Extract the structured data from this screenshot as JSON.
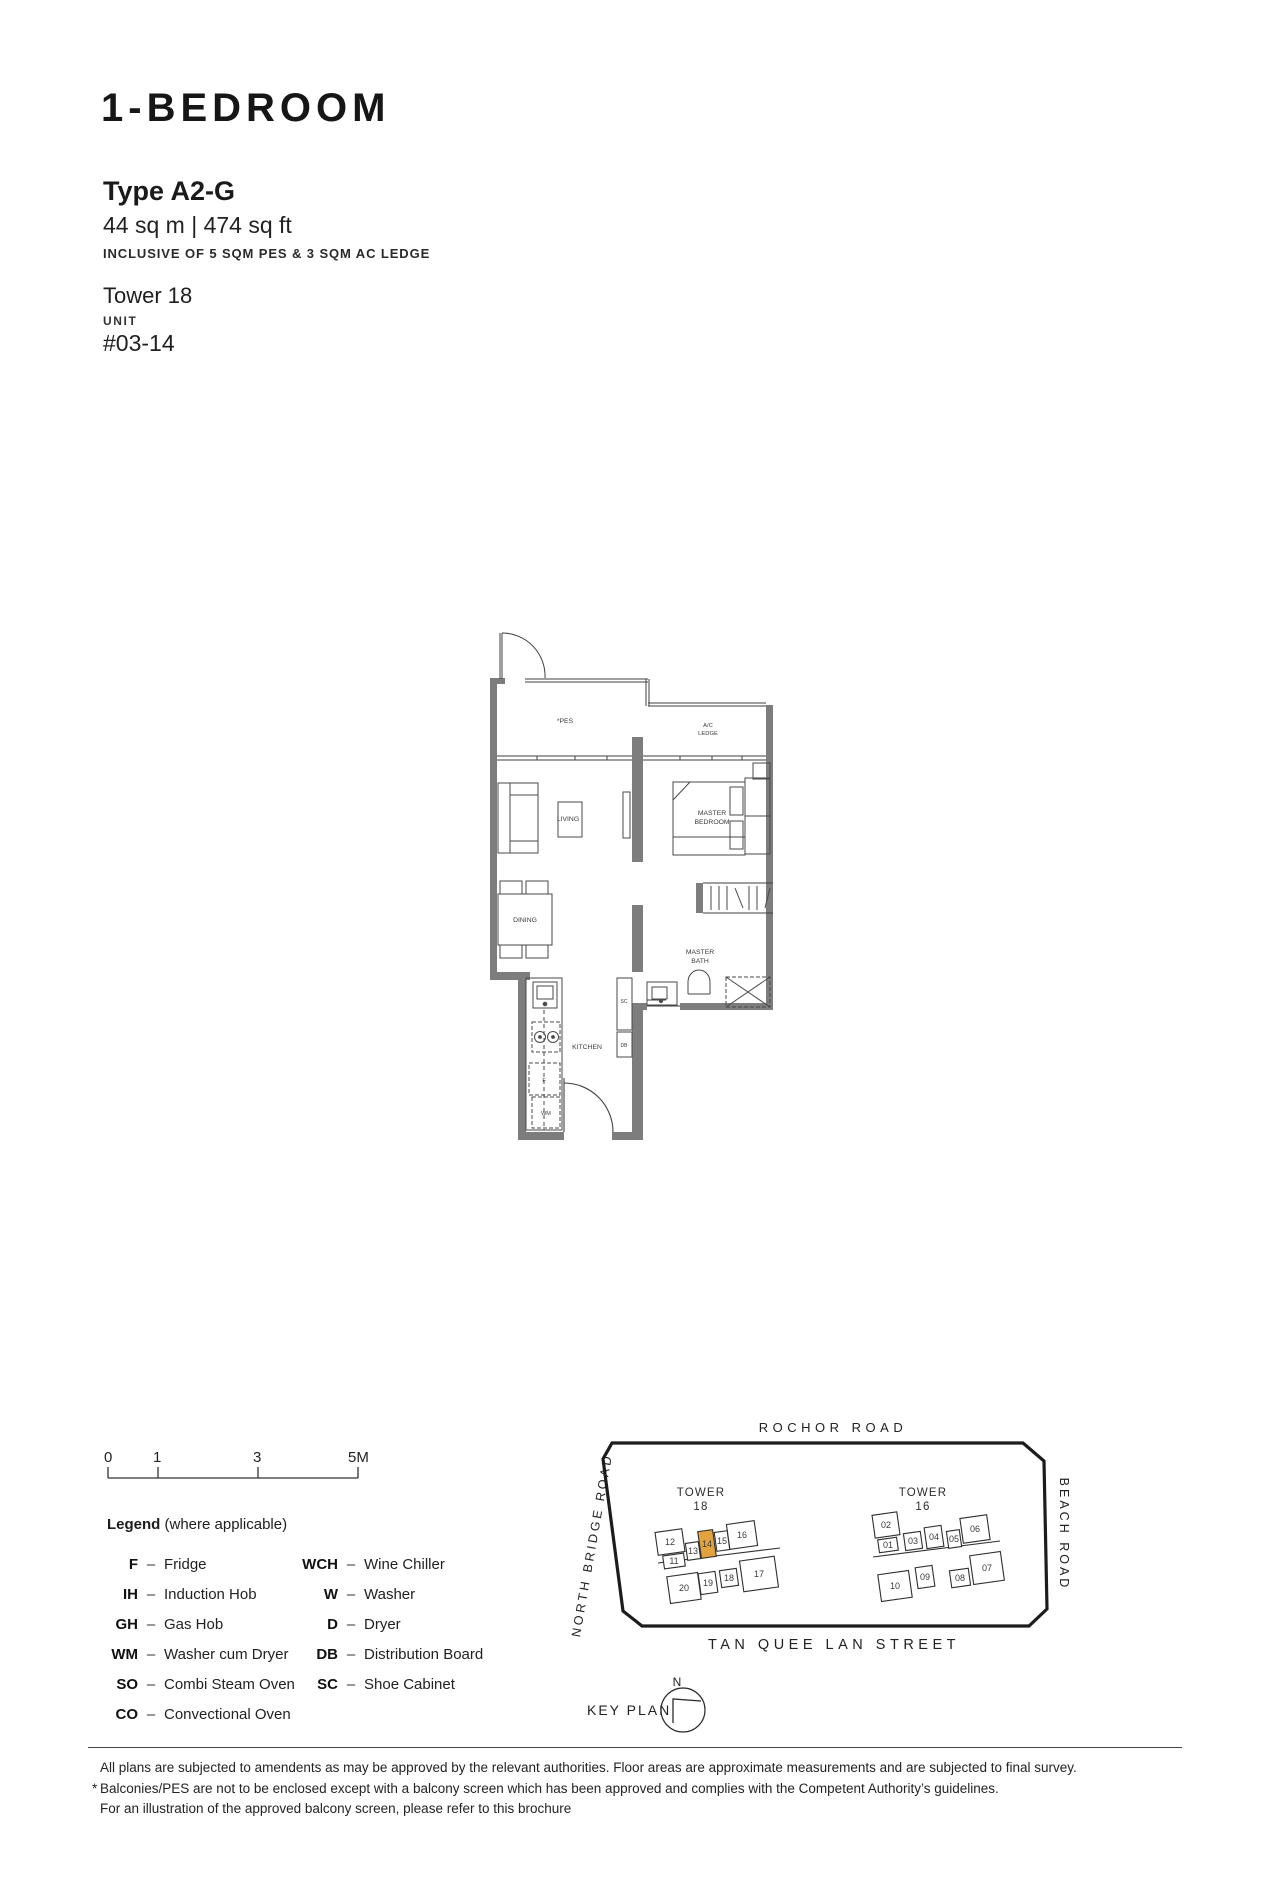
{
  "header": {
    "title": "1-BEDROOM",
    "type": "Type A2-G",
    "area": "44 sq m | 474 sq ft",
    "inclusive": "INCLUSIVE OF 5 SQM PES & 3 SQM AC LEDGE",
    "tower": "Tower 18",
    "unit_label": "UNIT",
    "unit_number": "#03-14"
  },
  "floor_plan": {
    "labels": {
      "pes": "*PES",
      "ac_ledge_1": "A/C",
      "ac_ledge_2": "LEDGE",
      "living": "LIVING",
      "master_bedroom_1": "MASTER",
      "master_bedroom_2": "BEDROOM",
      "dining": "DINING",
      "master_bath_1": "MASTER",
      "master_bath_2": "BATH",
      "kitchen": "KITCHEN",
      "shoe_cabinet": "SC",
      "distribution_board": "DB",
      "fridge": "F",
      "washer_dryer": "WM"
    }
  },
  "scale_bar": {
    "ticks": [
      "0",
      "1",
      "3",
      "5M"
    ]
  },
  "legend": {
    "title": "Legend",
    "subtitle": "(where applicable)",
    "separator": "–",
    "col1": [
      {
        "abbr": "F",
        "desc": "Fridge"
      },
      {
        "abbr": "IH",
        "desc": "Induction Hob"
      },
      {
        "abbr": "GH",
        "desc": "Gas Hob"
      },
      {
        "abbr": "WM",
        "desc": "Washer cum Dryer"
      },
      {
        "abbr": "SO",
        "desc": "Combi Steam Oven"
      },
      {
        "abbr": "CO",
        "desc": "Convectional Oven"
      }
    ],
    "col2": [
      {
        "abbr": "WCH",
        "desc": "Wine Chiller"
      },
      {
        "abbr": "W",
        "desc": "Washer"
      },
      {
        "abbr": "D",
        "desc": "Dryer"
      },
      {
        "abbr": "DB",
        "desc": "Distribution Board"
      },
      {
        "abbr": "SC",
        "desc": "Shoe Cabinet"
      }
    ]
  },
  "key_plan": {
    "roads": {
      "top": "ROCHOR ROAD",
      "left": "NORTH BRIDGE ROAD",
      "right": "BEACH ROAD",
      "bottom": "TAN QUEE LAN STREET"
    },
    "tower18": {
      "line1": "TOWER",
      "line2": "18",
      "units": [
        "12",
        "11",
        "13",
        "14",
        "15",
        "16",
        "20",
        "19",
        "18",
        "17"
      ]
    },
    "tower16": {
      "line1": "TOWER",
      "line2": "16",
      "units": [
        "02",
        "01",
        "03",
        "04",
        "05",
        "06",
        "10",
        "09",
        "08",
        "07"
      ]
    },
    "highlighted_unit": "14",
    "highlight_color": "#E2A33F",
    "key_plan_label": "KEY PLAN",
    "north_label": "N"
  },
  "disclaimer": {
    "line1": "All plans are subjected to amendents as may be approved by the relevant authorities. Floor areas are approximate measurements and are subjected to final survey.",
    "line2_marker": "*",
    "line2": "Balconies/PES are not to be enclosed except with a balcony screen which has been approved and complies with the Competent Authority’s guidelines.",
    "line3": "For an illustration of the approved balcony screen, please refer to this brochure"
  }
}
